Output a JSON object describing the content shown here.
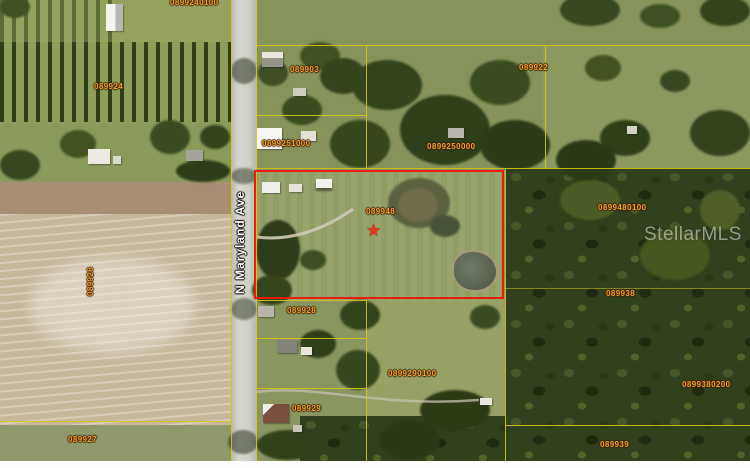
{
  "map": {
    "description": "Aerial parcel map with highlighted listing parcel",
    "road_label": "N Maryland Ave",
    "watermark": "StellarMLS",
    "star_glyph": "★",
    "highlight": {
      "parcel_id": "089948",
      "border_color": "#ea1b0d"
    },
    "colors": {
      "parcel_label": "#f0a22a",
      "parcel_line": "#d6c31a",
      "highlight_border": "#ea1b0d",
      "watermark": "rgba(255,255,255,0.5)"
    },
    "parcel_labels": [
      {
        "id": "0899240100",
        "x": 170,
        "y": -2
      },
      {
        "id": "089924",
        "x": 94,
        "y": 82
      },
      {
        "id": "089903",
        "x": 290,
        "y": 65
      },
      {
        "id": "089922",
        "x": 519,
        "y": 63
      },
      {
        "id": "0899251000",
        "x": 262,
        "y": 139
      },
      {
        "id": "0899250000",
        "x": 427,
        "y": 142
      },
      {
        "id": "089948",
        "x": 366,
        "y": 207
      },
      {
        "id": "0899480100",
        "x": 598,
        "y": 203
      },
      {
        "id": "089926",
        "x": 86,
        "y": 296,
        "vertical": true
      },
      {
        "id": "089938",
        "x": 606,
        "y": 289
      },
      {
        "id": "089928",
        "x": 287,
        "y": 306
      },
      {
        "id": "0899290100",
        "x": 388,
        "y": 369
      },
      {
        "id": "0899380200",
        "x": 682,
        "y": 380
      },
      {
        "id": "089929",
        "x": 292,
        "y": 404
      },
      {
        "id": "089927",
        "x": 68,
        "y": 435
      },
      {
        "id": "089939",
        "x": 600,
        "y": 440
      }
    ]
  }
}
